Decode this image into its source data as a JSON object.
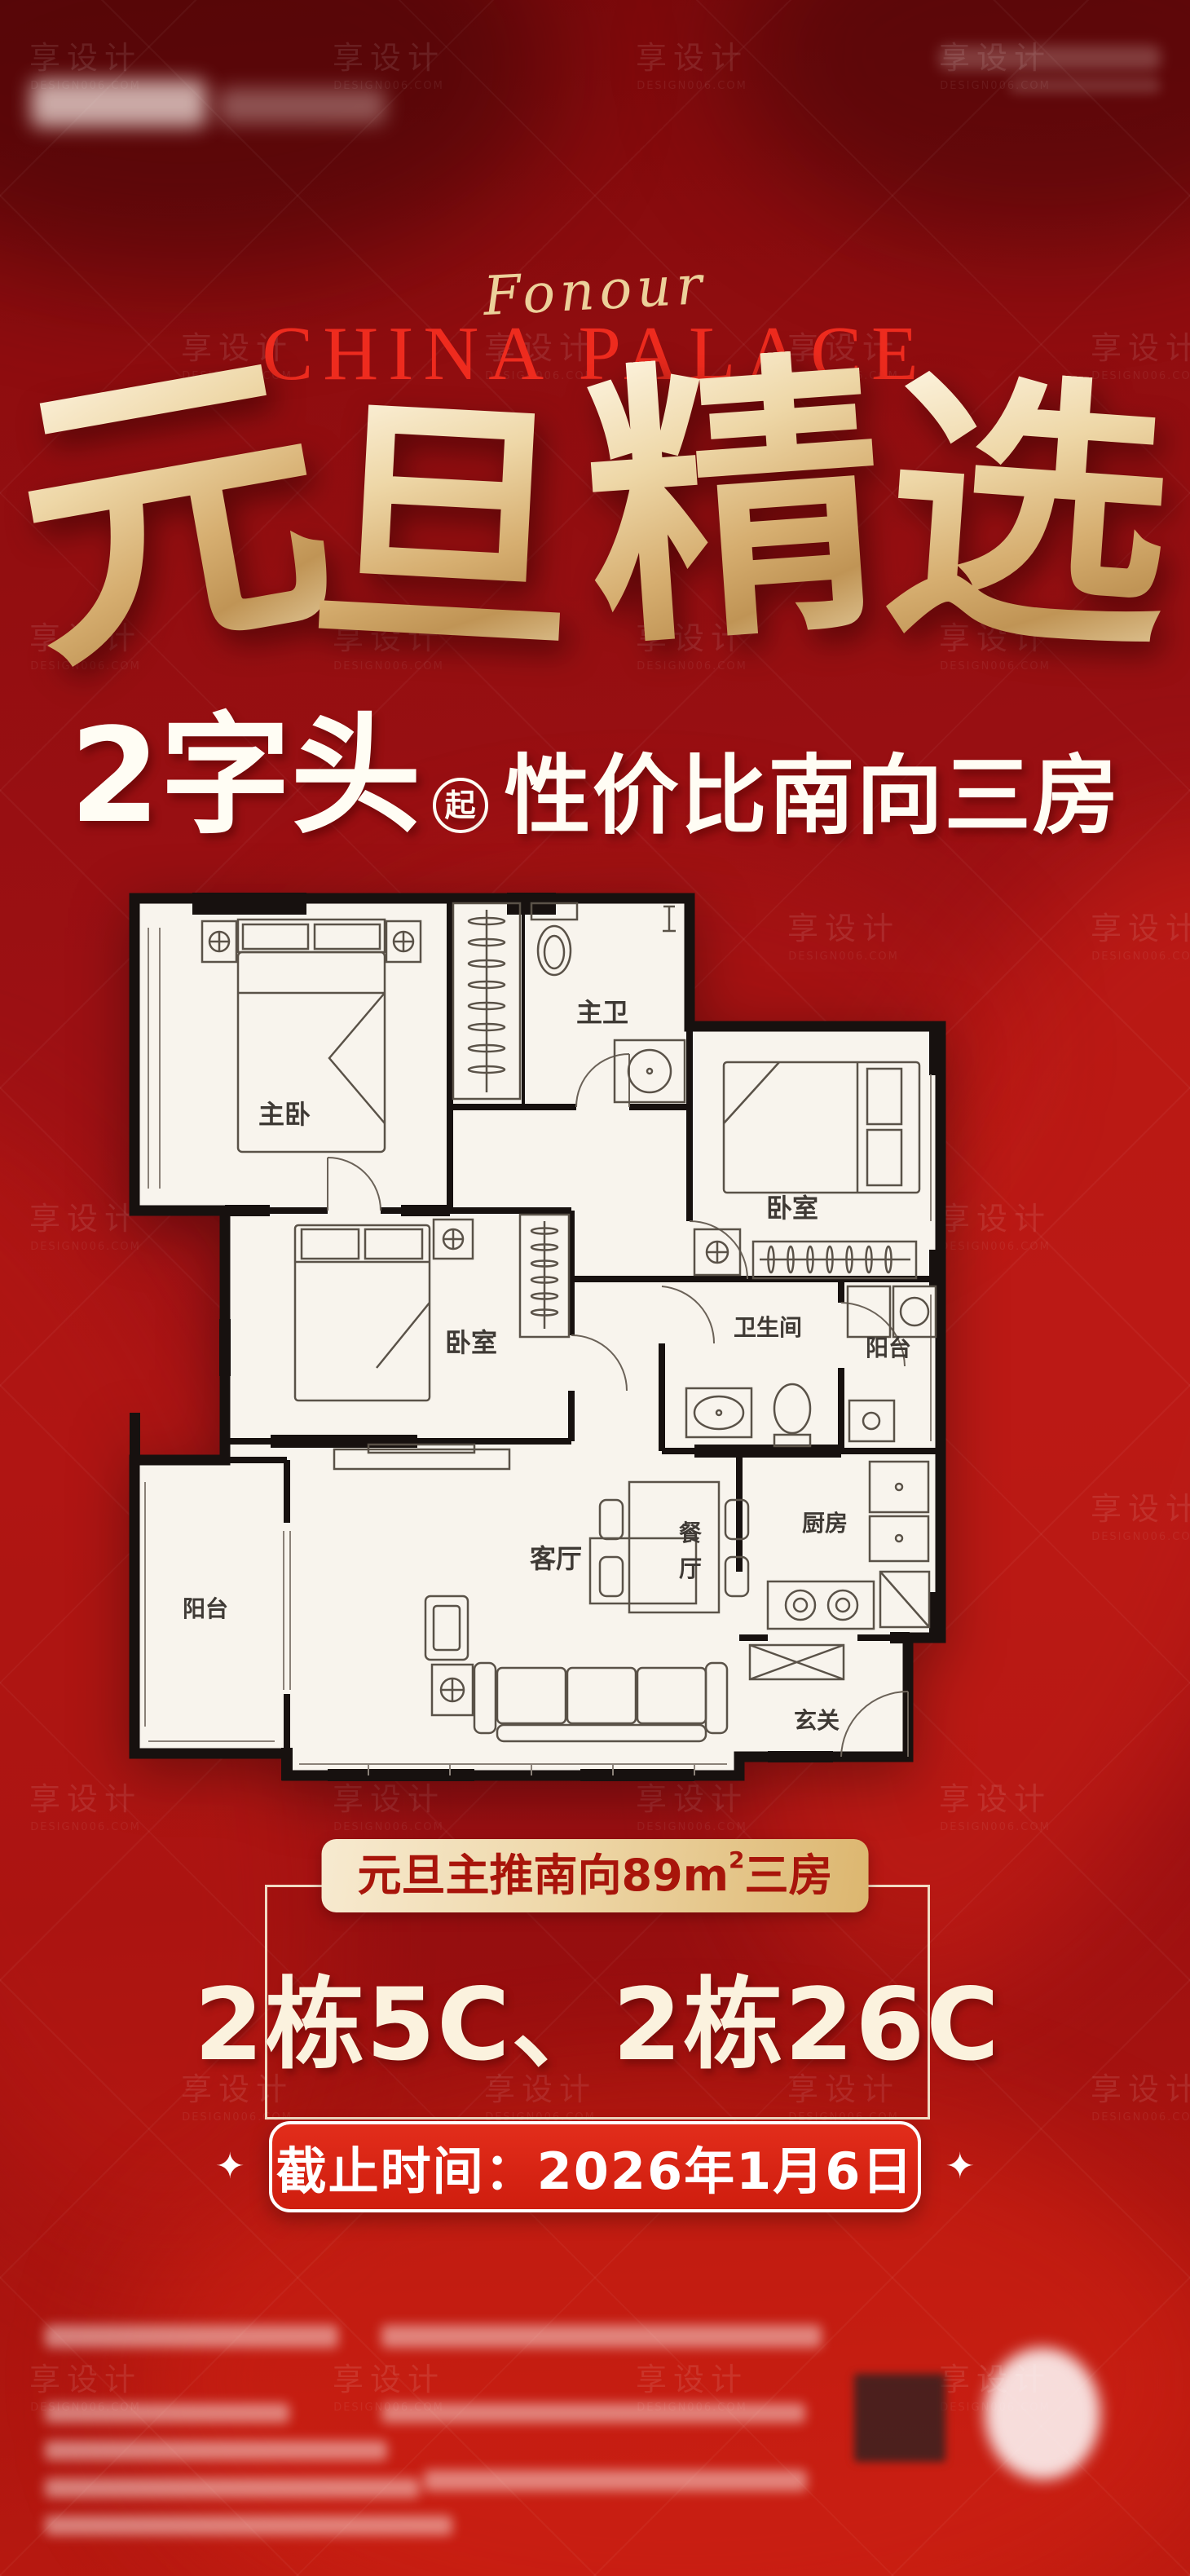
{
  "colors": {
    "background_red": "#9c1013",
    "bright_brand_red": "#ee2b1e",
    "accent_gold": "#e4c48c",
    "cream": "#f8efda",
    "pill_red": "#d8281a",
    "plan_paper": "#f8f4ed",
    "wall_black": "#17110f"
  },
  "watermark": {
    "line1": "享设计",
    "line2": "DESIGN006.COM"
  },
  "header": {
    "script": "Fonour",
    "brand": "CHINA PALACE"
  },
  "hero": {
    "chars": [
      "元",
      "旦",
      "精",
      "选"
    ]
  },
  "subline": {
    "price": "2字头",
    "qi": "起",
    "tagline": "性价比南向三房"
  },
  "floorplan": {
    "rooms": {
      "master": "主卧",
      "master_bath": "主卫",
      "bedroom_a": "卧室",
      "bedroom_b": "卧室",
      "bathroom": "卫生间",
      "balcony_right": "阳台",
      "dining_1": "餐",
      "dining_2": "厅",
      "kitchen": "厨房",
      "balcony_left": "阳台",
      "living": "客厅",
      "entry": "玄关"
    }
  },
  "promo": {
    "badge_pre": "元旦主推南向89m",
    "badge_sup": "2",
    "badge_post": "三房",
    "units": "2栋5C、2栋26C"
  },
  "deadline": {
    "star": "✦",
    "label": "截止时间：2026年1月6日"
  }
}
